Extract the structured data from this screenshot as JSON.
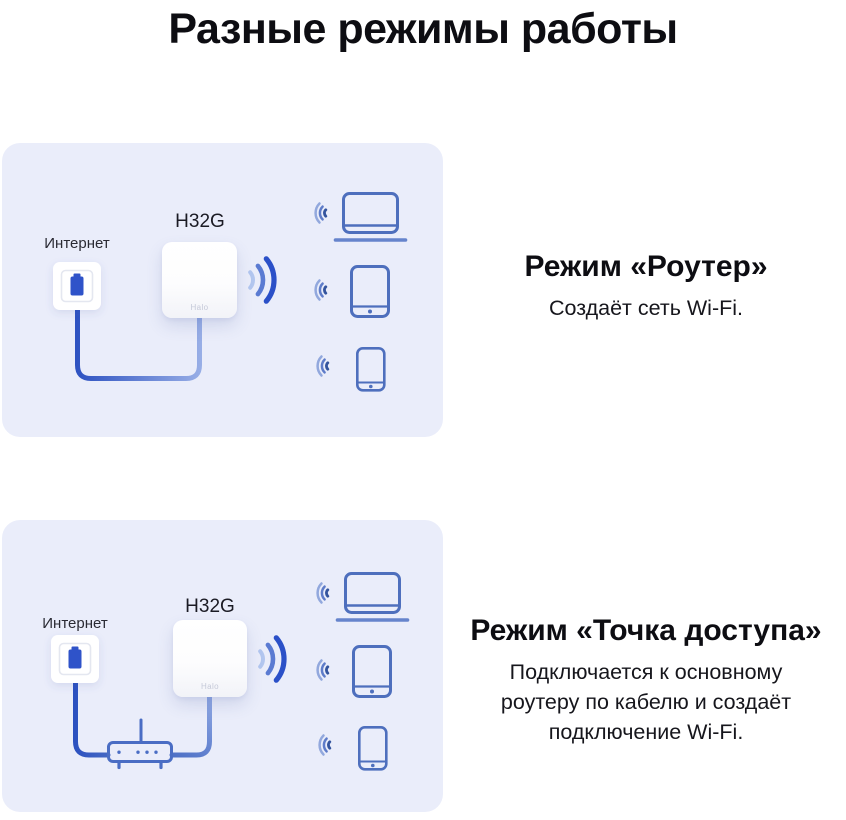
{
  "title": "Разные режимы работы",
  "panels": [
    {
      "id": "router-mode",
      "internet_label": "Интернет",
      "device_label": "H32G",
      "device_brand": "Halo",
      "heading": "Режим «Роутер»",
      "description": "Создаёт сеть Wi-Fi.",
      "connected_devices": [
        "laptop",
        "tablet",
        "smartphone"
      ]
    },
    {
      "id": "access-point-mode",
      "internet_label": "Интернет",
      "device_label": "H32G",
      "device_brand": "Halo",
      "heading": "Режим «Точка доступа»",
      "description": "Подключается к основному роутеру по кабелю и создаёт подключение Wi-Fi.",
      "connected_devices": [
        "laptop",
        "tablet",
        "smartphone"
      ]
    }
  ],
  "colors": {
    "panel_background": "#EAEDFA",
    "device_outline_blue": "#4E6FBD",
    "wave_dark_blue": "#2B50C8",
    "wave_mid_blue": "#5B7BD2",
    "wave_light_blue": "#B2C6EF",
    "cable_dark_blue": "#2A4FC0",
    "cable_light_blue": "#9AB0E7",
    "plug_blue": "#2F53C9",
    "title_text": "#0d0d12"
  }
}
